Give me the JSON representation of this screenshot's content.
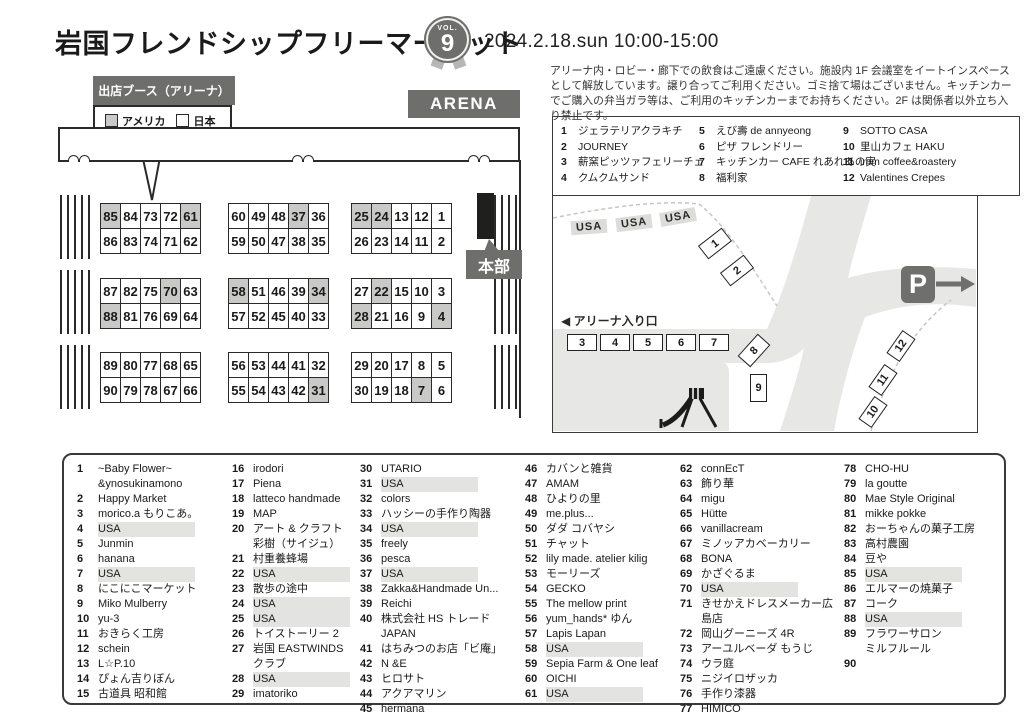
{
  "header": {
    "title": "岩国フレンドシップフリーマーケット",
    "badge": {
      "vol_label": "VOL.",
      "vol_number": "9"
    },
    "datetime": "2024.2.18.sun 10:00-15:00"
  },
  "notice": "アリーナ内・ロビー・廊下での飲食はご遠慮ください。施設内 1F 会議室をイートインスペースとして解放しています。譲り合ってご利用ください。ゴミ捨て場はございません。キッチンカーでご購入の弁当ガラ等は、ご利用のキッチンカーまでお持ちください。2F は関係者以外立ち入り禁止です。",
  "colors": {
    "accent_gray": "#6e6e6c",
    "usa_booth_gray": "#c9c9c7",
    "road_gray": "#e7e7e5",
    "usa_highlight": "#e3e3e1"
  },
  "arena_map": {
    "arena_label": "ARENA",
    "hq_label": "本部",
    "legend": {
      "title": "出店ブース（アリーナ）",
      "items": [
        {
          "label": "アメリカ",
          "swatch": "#c9c9c7"
        },
        {
          "label": "日本",
          "swatch": "#ffffff"
        }
      ]
    },
    "booth_blocks": [
      {
        "rows": [
          [
            "85",
            "84",
            "73",
            "72",
            "61"
          ],
          [
            "86",
            "83",
            "74",
            "71",
            "62"
          ]
        ],
        "usa": [
          "85",
          "61"
        ]
      },
      {
        "rows": [
          [
            "60",
            "49",
            "48",
            "37",
            "36"
          ],
          [
            "59",
            "50",
            "47",
            "38",
            "35"
          ]
        ],
        "usa": [
          "37"
        ]
      },
      {
        "rows": [
          [
            "25",
            "24",
            "13",
            "12",
            "1"
          ],
          [
            "26",
            "23",
            "14",
            "11",
            "2"
          ]
        ],
        "usa": [
          "25",
          "24"
        ]
      },
      {
        "rows": [
          [
            "87",
            "82",
            "75",
            "70",
            "63"
          ],
          [
            "88",
            "81",
            "76",
            "69",
            "64"
          ]
        ],
        "usa": [
          "70",
          "88"
        ]
      },
      {
        "rows": [
          [
            "58",
            "51",
            "46",
            "39",
            "34"
          ],
          [
            "57",
            "52",
            "45",
            "40",
            "33"
          ]
        ],
        "usa": [
          "58",
          "34"
        ]
      },
      {
        "rows": [
          [
            "27",
            "22",
            "15",
            "10",
            "3"
          ],
          [
            "28",
            "21",
            "16",
            "9",
            "4"
          ]
        ],
        "usa": [
          "22",
          "28",
          "4"
        ]
      },
      {
        "rows": [
          [
            "89",
            "80",
            "77",
            "68",
            "65"
          ],
          [
            "90",
            "79",
            "78",
            "67",
            "66"
          ]
        ],
        "usa": []
      },
      {
        "rows": [
          [
            "56",
            "53",
            "44",
            "41",
            "32"
          ],
          [
            "55",
            "54",
            "43",
            "42",
            "31"
          ]
        ],
        "usa": [
          "31"
        ]
      },
      {
        "rows": [
          [
            "29",
            "20",
            "17",
            "8",
            "5"
          ],
          [
            "30",
            "19",
            "18",
            "7",
            "6"
          ]
        ],
        "usa": [
          "7"
        ]
      }
    ]
  },
  "food_vendors": [
    {
      "no": "1",
      "name": "ジェラテリアクラキチ"
    },
    {
      "no": "2",
      "name": "JOURNEY"
    },
    {
      "no": "3",
      "name": "薪窯ピッツァフェリーチェ"
    },
    {
      "no": "4",
      "name": "クムクムサンド"
    },
    {
      "no": "5",
      "name": "えび壽 de annyeong"
    },
    {
      "no": "6",
      "name": "ピザ フレンドリー"
    },
    {
      "no": "7",
      "name": "キッチンカー CAFE れあれあの実"
    },
    {
      "no": "8",
      "name": "福利家"
    },
    {
      "no": "9",
      "name": "SOTTO CASA"
    },
    {
      "no": "10",
      "name": "里山カフェ HAKU"
    },
    {
      "no": "11",
      "name": "imm coffee&roastery"
    },
    {
      "no": "12",
      "name": "Valentines Crepes"
    }
  ],
  "outdoor_map": {
    "entrance_label": "◀ アリーナ入り口",
    "parking_label": "P",
    "usa_labels": [
      "USA",
      "USA",
      "USA"
    ],
    "spots": [
      "1",
      "2",
      "3",
      "4",
      "5",
      "6",
      "7",
      "8",
      "9",
      "10",
      "11",
      "12"
    ]
  },
  "vendors": [
    {
      "no": "1",
      "name": "~Baby Flower~\n&ynosukinamono",
      "usa": false
    },
    {
      "no": "2",
      "name": "Happy Market",
      "usa": false
    },
    {
      "no": "3",
      "name": "morico.a もりこあ。",
      "usa": false
    },
    {
      "no": "4",
      "name": "USA",
      "usa": true
    },
    {
      "no": "5",
      "name": "Junmin",
      "usa": false
    },
    {
      "no": "6",
      "name": "hanana",
      "usa": false
    },
    {
      "no": "7",
      "name": "USA",
      "usa": true
    },
    {
      "no": "8",
      "name": "にこにこマーケット",
      "usa": false
    },
    {
      "no": "9",
      "name": "Miko Mulberry",
      "usa": false
    },
    {
      "no": "10",
      "name": "yu-3",
      "usa": false
    },
    {
      "no": "11",
      "name": "おきらく工房",
      "usa": false
    },
    {
      "no": "12",
      "name": "schein",
      "usa": false
    },
    {
      "no": "13",
      "name": "L☆P.10",
      "usa": false
    },
    {
      "no": "14",
      "name": "ぴょん吉りぼん",
      "usa": false
    },
    {
      "no": "15",
      "name": "古道具 昭和館",
      "usa": false
    },
    {
      "no": "16",
      "name": "irodori",
      "usa": false
    },
    {
      "no": "17",
      "name": "Piena",
      "usa": false
    },
    {
      "no": "18",
      "name": "latteco handmade",
      "usa": false
    },
    {
      "no": "19",
      "name": "MAP",
      "usa": false
    },
    {
      "no": "20",
      "name": "アート & クラフト\n彩樹（サイジュ）",
      "usa": false
    },
    {
      "no": "21",
      "name": "村重養蜂場",
      "usa": false
    },
    {
      "no": "22",
      "name": "USA",
      "usa": true
    },
    {
      "no": "23",
      "name": "散歩の途中",
      "usa": false
    },
    {
      "no": "24",
      "name": "USA",
      "usa": true
    },
    {
      "no": "25",
      "name": "USA",
      "usa": true
    },
    {
      "no": "26",
      "name": "トイストーリー 2",
      "usa": false
    },
    {
      "no": "27",
      "name": "岩国 EASTWINDS\nクラブ",
      "usa": false
    },
    {
      "no": "28",
      "name": "USA",
      "usa": true
    },
    {
      "no": "29",
      "name": "imatoriko",
      "usa": false
    },
    {
      "no": "30",
      "name": "UTARIO",
      "usa": false
    },
    {
      "no": "31",
      "name": "USA",
      "usa": true
    },
    {
      "no": "32",
      "name": "colors",
      "usa": false
    },
    {
      "no": "33",
      "name": "ハッシーの手作り陶器",
      "usa": false
    },
    {
      "no": "34",
      "name": "USA",
      "usa": true
    },
    {
      "no": "35",
      "name": "freely",
      "usa": false
    },
    {
      "no": "36",
      "name": "pesca",
      "usa": false
    },
    {
      "no": "37",
      "name": "USA",
      "usa": true
    },
    {
      "no": "38",
      "name": "Zakka&Handmade Un...",
      "usa": false
    },
    {
      "no": "39",
      "name": "Reichi",
      "usa": false
    },
    {
      "no": "40",
      "name": "株式会社 HS トレード JAPAN",
      "usa": false
    },
    {
      "no": "41",
      "name": "はちみつのお店「ビ庵」",
      "usa": false
    },
    {
      "no": "42",
      "name": "N &E",
      "usa": false
    },
    {
      "no": "43",
      "name": "ヒロサト",
      "usa": false
    },
    {
      "no": "44",
      "name": "アクアマリン",
      "usa": false
    },
    {
      "no": "45",
      "name": "hermana",
      "usa": false
    },
    {
      "no": "46",
      "name": "カバンと雑貨",
      "usa": false
    },
    {
      "no": "47",
      "name": "AMAM",
      "usa": false
    },
    {
      "no": "48",
      "name": "ひよりの里",
      "usa": false
    },
    {
      "no": "49",
      "name": "me.plus...",
      "usa": false
    },
    {
      "no": "50",
      "name": "ダダ コバヤシ",
      "usa": false
    },
    {
      "no": "51",
      "name": "チャット",
      "usa": false
    },
    {
      "no": "52",
      "name": "lily made. atelier kilig",
      "usa": false
    },
    {
      "no": "53",
      "name": "モーリーズ",
      "usa": false
    },
    {
      "no": "54",
      "name": "GECKO",
      "usa": false
    },
    {
      "no": "55",
      "name": "The mellow print",
      "usa": false
    },
    {
      "no": "56",
      "name": "yum_hands* ゆん",
      "usa": false
    },
    {
      "no": "57",
      "name": "Lapis Lapan",
      "usa": false
    },
    {
      "no": "58",
      "name": "USA",
      "usa": true
    },
    {
      "no": "59",
      "name": "Sepia Farm & One leaf",
      "usa": false
    },
    {
      "no": "60",
      "name": "OICHI",
      "usa": false
    },
    {
      "no": "61",
      "name": "USA",
      "usa": true
    },
    {
      "no": "62",
      "name": "connEcT",
      "usa": false
    },
    {
      "no": "63",
      "name": "飾り華",
      "usa": false
    },
    {
      "no": "64",
      "name": "migu",
      "usa": false
    },
    {
      "no": "65",
      "name": "Hütte",
      "usa": false
    },
    {
      "no": "66",
      "name": "vanillacream",
      "usa": false
    },
    {
      "no": "67",
      "name": "ミノッアカベーカリー",
      "usa": false
    },
    {
      "no": "68",
      "name": "BONA",
      "usa": false
    },
    {
      "no": "69",
      "name": "かざぐるま",
      "usa": false
    },
    {
      "no": "70",
      "name": "USA",
      "usa": true
    },
    {
      "no": "71",
      "name": "きせかえドレスメーカー広島店",
      "usa": false
    },
    {
      "no": "72",
      "name": "岡山グーニーズ 4R",
      "usa": false
    },
    {
      "no": "73",
      "name": "アーユルベーダ もうじ",
      "usa": false
    },
    {
      "no": "74",
      "name": "ウラ庭",
      "usa": false
    },
    {
      "no": "75",
      "name": "ニジイロザッカ",
      "usa": false
    },
    {
      "no": "76",
      "name": "手作り漆器",
      "usa": false
    },
    {
      "no": "77",
      "name": "HIMICO",
      "usa": false
    },
    {
      "no": "78",
      "name": "CHO-HU",
      "usa": false
    },
    {
      "no": "79",
      "name": "la goutte",
      "usa": false
    },
    {
      "no": "80",
      "name": "Mae Style Original",
      "usa": false
    },
    {
      "no": "81",
      "name": "mikke pokke",
      "usa": false
    },
    {
      "no": "82",
      "name": "おーちゃんの菓子工房",
      "usa": false
    },
    {
      "no": "83",
      "name": "高村農園",
      "usa": false
    },
    {
      "no": "84",
      "name": "豆や",
      "usa": false
    },
    {
      "no": "85",
      "name": "USA",
      "usa": true
    },
    {
      "no": "86",
      "name": "エルマーの焼菓子",
      "usa": false
    },
    {
      "no": "87",
      "name": "コーク",
      "usa": false
    },
    {
      "no": "88",
      "name": "USA",
      "usa": true
    },
    {
      "no": "89",
      "name": "フラワーサロン\nミルフルール",
      "usa": false
    },
    {
      "no": "90",
      "name": "",
      "usa": false
    }
  ]
}
